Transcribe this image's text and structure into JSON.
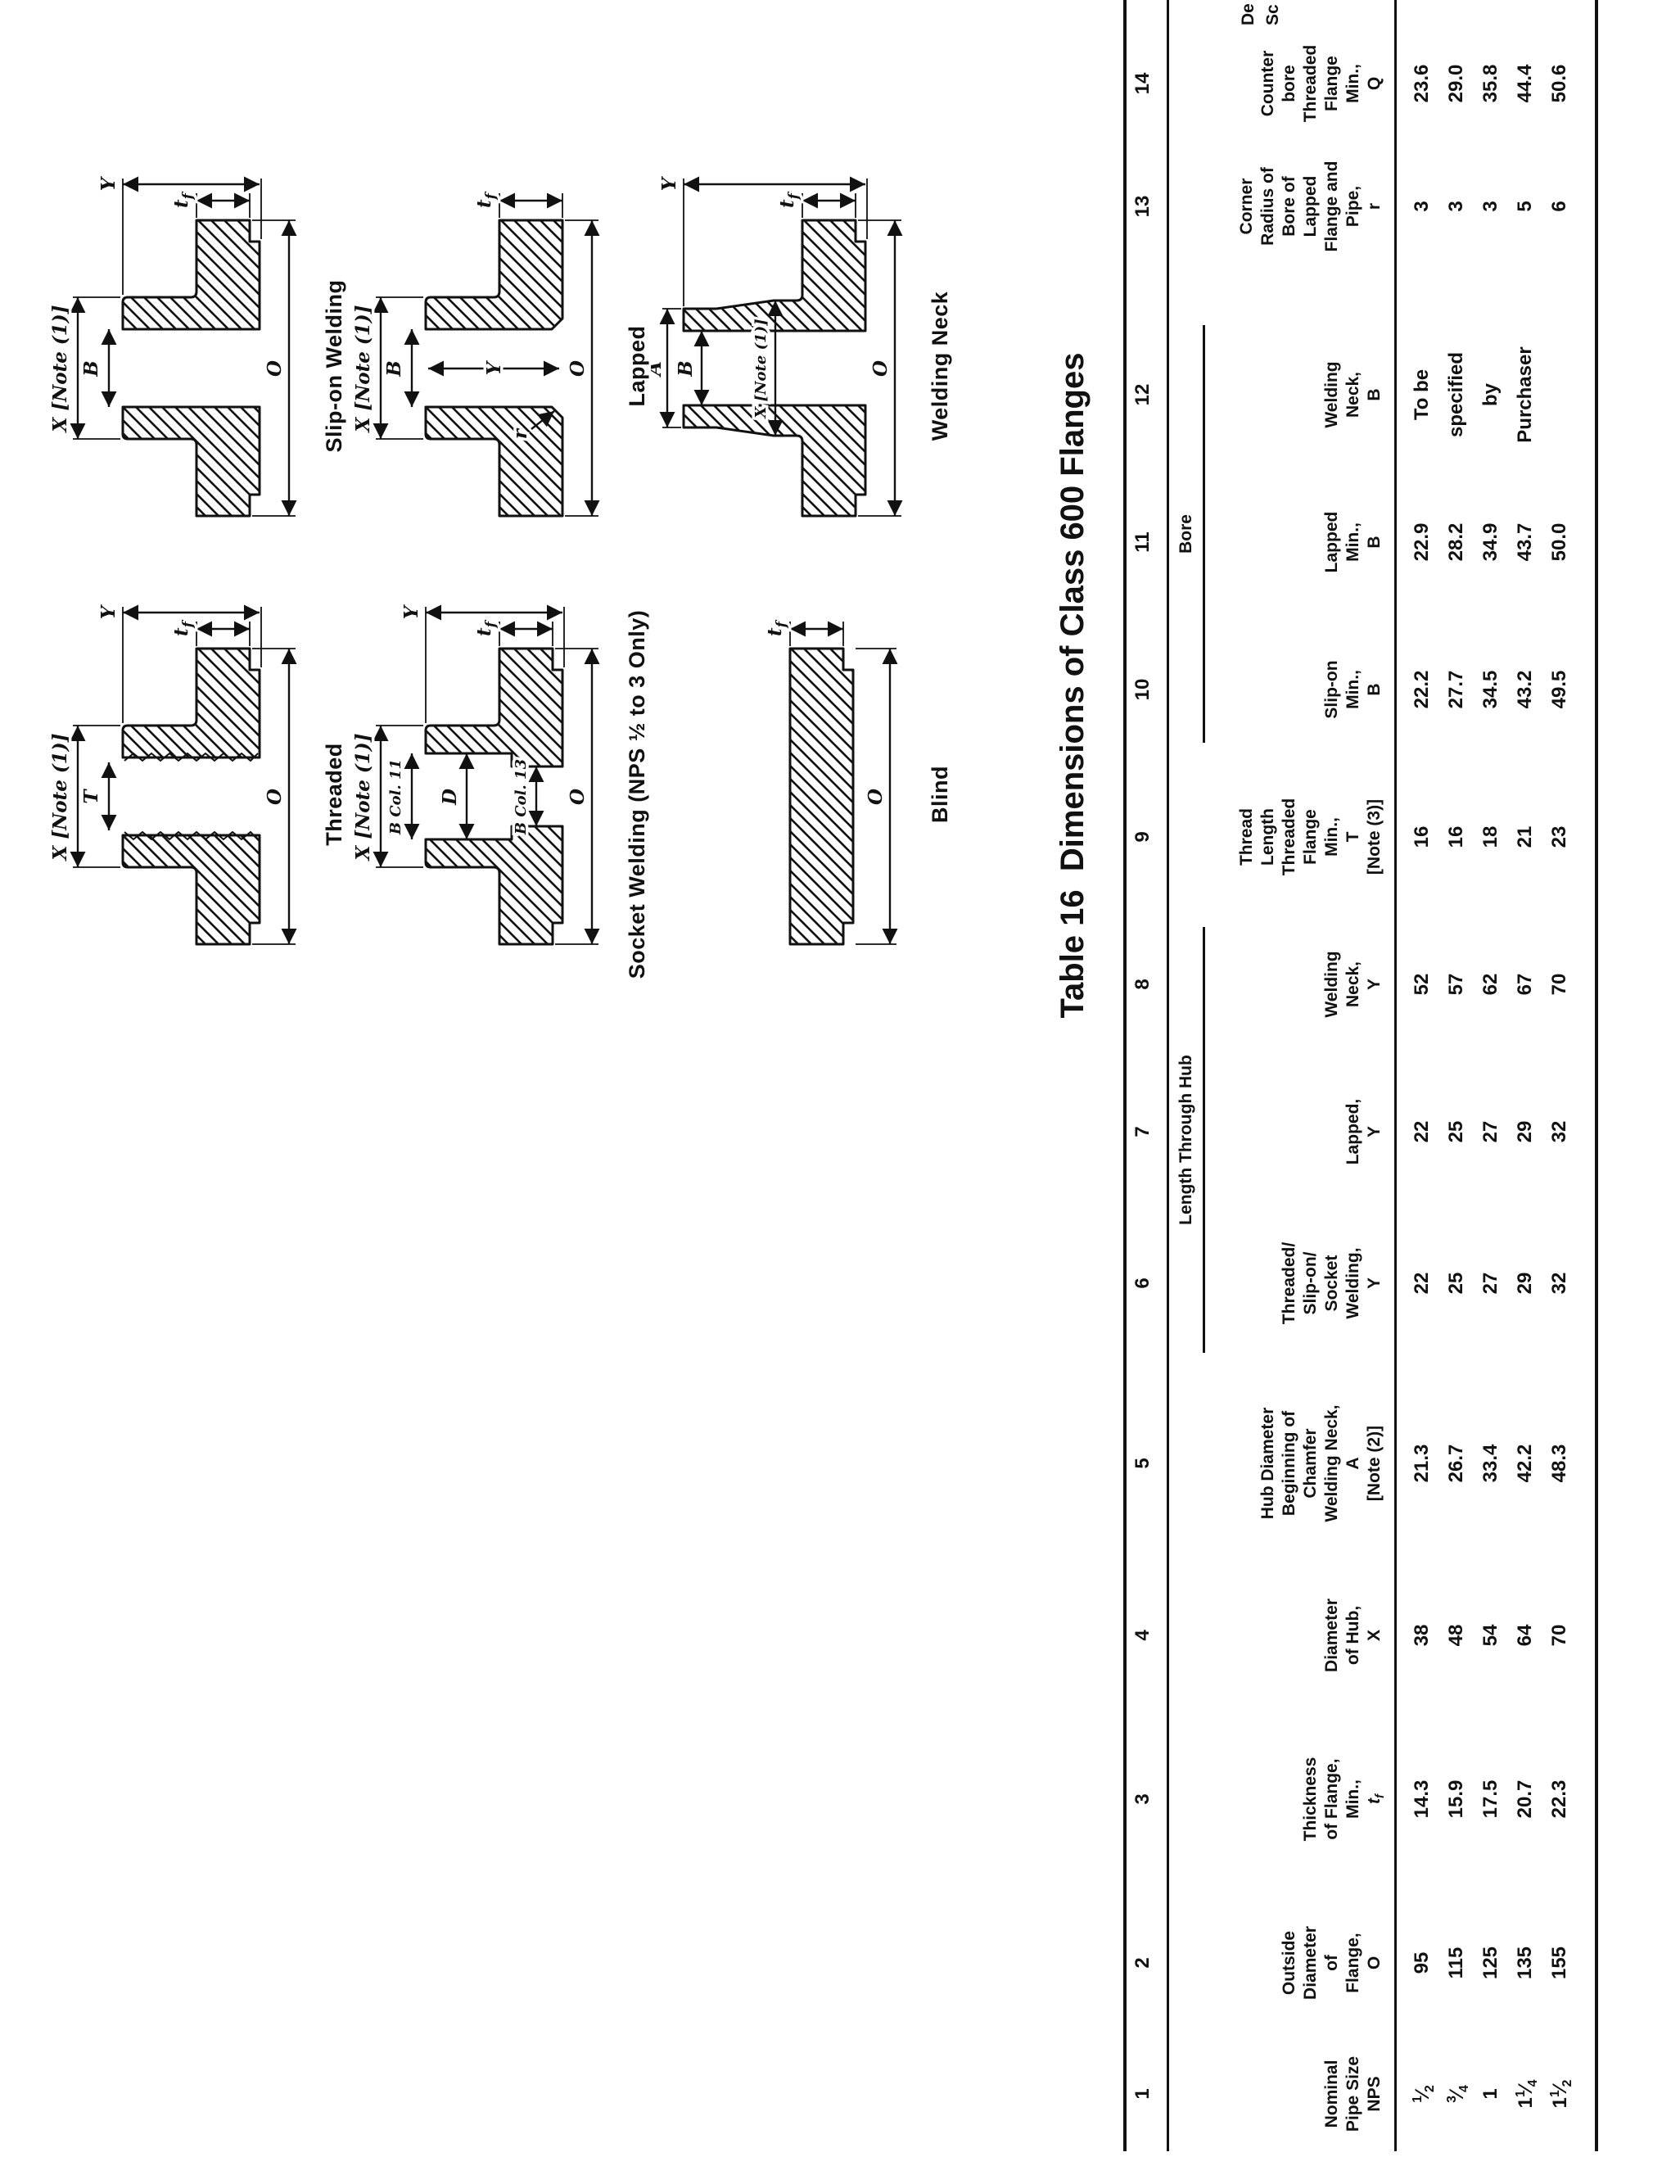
{
  "page": {
    "title": "Table 16  Dimensions of Class 600 Flanges"
  },
  "figures": [
    {
      "id": "threaded",
      "caption": "Threaded",
      "labels": {
        "X": "X [Note (1)]",
        "T": "T",
        "O": "O",
        "Y": "Y",
        "tf": "tf"
      }
    },
    {
      "id": "slip_on",
      "caption": "Slip-on Welding",
      "labels": {
        "X": "X [Note (1)]",
        "B": "B",
        "O": "O",
        "Y": "Y",
        "tf": "tf"
      }
    },
    {
      "id": "socket",
      "caption": "Socket Welding (NPS ½ to 3 Only)",
      "labels": {
        "X": "X [Note (1)]",
        "B_col11": "B Col. 11",
        "D": "D",
        "B_col13": "B Col. 13",
        "O": "O",
        "Y": "Y",
        "tf": "tf"
      }
    },
    {
      "id": "lapped",
      "caption": "Lapped",
      "labels": {
        "X": "X [Note (1)]",
        "B": "B",
        "Y": "Y",
        "r": "r",
        "O": "O",
        "tf": "tf"
      }
    },
    {
      "id": "blind",
      "caption": "Blind",
      "labels": {
        "O": "O",
        "tf": "tf"
      }
    },
    {
      "id": "welding_neck",
      "caption": "Welding Neck",
      "labels": {
        "X": "X [Note (1)]",
        "A": "A",
        "B": "B",
        "O": "O",
        "Y": "Y",
        "tf": "tf"
      }
    }
  ],
  "table": {
    "groups": [
      {
        "id": "hub",
        "label": "Length Through Hub"
      },
      {
        "id": "bore",
        "label": "Bore"
      }
    ],
    "columns": [
      {
        "num": "1",
        "header_lines": [
          "Nominal",
          "Pipe Size",
          "NPS"
        ]
      },
      {
        "num": "2",
        "header_lines": [
          "Outside",
          "Diameter",
          "of",
          "Flange,",
          "O"
        ]
      },
      {
        "num": "3",
        "header_lines": [
          "Thickness",
          "of Flange,",
          "Min.,",
          "t_f"
        ]
      },
      {
        "num": "4",
        "header_lines": [
          "Diameter",
          "of Hub,",
          "X"
        ]
      },
      {
        "num": "5",
        "header_lines": [
          "Hub Diameter",
          "Beginning of",
          "Chamfer",
          "Welding Neck,",
          "A",
          "[Note (2)]"
        ]
      },
      {
        "num": "6",
        "header_lines": [
          "Threaded/",
          "Slip-on/",
          "Socket",
          "Welding,",
          "Y"
        ],
        "group": "hub"
      },
      {
        "num": "7",
        "header_lines": [
          "Lapped,",
          "Y"
        ],
        "group": "hub"
      },
      {
        "num": "8",
        "header_lines": [
          "Welding",
          "Neck,",
          "Y"
        ],
        "group": "hub"
      },
      {
        "num": "9",
        "header_lines": [
          "Thread",
          "Length",
          "Threaded",
          "Flange",
          "Min.,",
          "T",
          "[Note (3)]"
        ]
      },
      {
        "num": "10",
        "header_lines": [
          "Slip-on",
          "Min.,",
          "B"
        ],
        "group": "bore"
      },
      {
        "num": "11",
        "header_lines": [
          "Lapped",
          "Min.,",
          "B"
        ],
        "group": "bore"
      },
      {
        "num": "12",
        "header_lines": [
          "Welding",
          "Neck,",
          "B"
        ],
        "group": "bore"
      },
      {
        "num": "13",
        "header_lines": [
          "Corner",
          "Radius of",
          "Bore of",
          "Lapped",
          "Flange and",
          "Pipe,",
          "r"
        ]
      },
      {
        "num": "14",
        "header_lines": [
          "Counter",
          "bore",
          "Threaded",
          "Flange",
          "Min.,",
          "Q"
        ]
      }
    ],
    "col15_fragments": [
      "De",
      "Sc"
    ],
    "nps": [
      {
        "whole": "",
        "num": "1",
        "den": "2"
      },
      {
        "whole": "",
        "num": "3",
        "den": "4"
      },
      {
        "whole": "1",
        "num": "",
        "den": ""
      },
      {
        "whole": "1",
        "num": "1",
        "den": "4"
      },
      {
        "whole": "1",
        "num": "1",
        "den": "2"
      }
    ],
    "rows": [
      {
        "o": "95",
        "tf": "14.3",
        "x": "38",
        "a": "21.3",
        "y_tss": "22",
        "y_lap": "22",
        "y_wn": "52",
        "t": "16",
        "b_so": "22.2",
        "b_lap": "22.9",
        "b_wn": "To be",
        "r": "3",
        "q": "23.6"
      },
      {
        "o": "115",
        "tf": "15.9",
        "x": "48",
        "a": "26.7",
        "y_tss": "25",
        "y_lap": "25",
        "y_wn": "57",
        "t": "16",
        "b_so": "27.7",
        "b_lap": "28.2",
        "b_wn": "specified",
        "r": "3",
        "q": "29.0"
      },
      {
        "o": "125",
        "tf": "17.5",
        "x": "54",
        "a": "33.4",
        "y_tss": "27",
        "y_lap": "27",
        "y_wn": "62",
        "t": "18",
        "b_so": "34.5",
        "b_lap": "34.9",
        "b_wn": "by",
        "r": "3",
        "q": "35.8"
      },
      {
        "o": "135",
        "tf": "20.7",
        "x": "64",
        "a": "42.2",
        "y_tss": "29",
        "y_lap": "29",
        "y_wn": "67",
        "t": "21",
        "b_so": "43.2",
        "b_lap": "43.7",
        "b_wn": "Purchaser",
        "r": "5",
        "q": "44.4"
      },
      {
        "o": "155",
        "tf": "22.3",
        "x": "70",
        "a": "48.3",
        "y_tss": "32",
        "y_lap": "32",
        "y_wn": "70",
        "t": "23",
        "b_so": "49.5",
        "b_lap": "50.0",
        "b_wn": "",
        "r": "6",
        "q": "50.6"
      }
    ]
  }
}
